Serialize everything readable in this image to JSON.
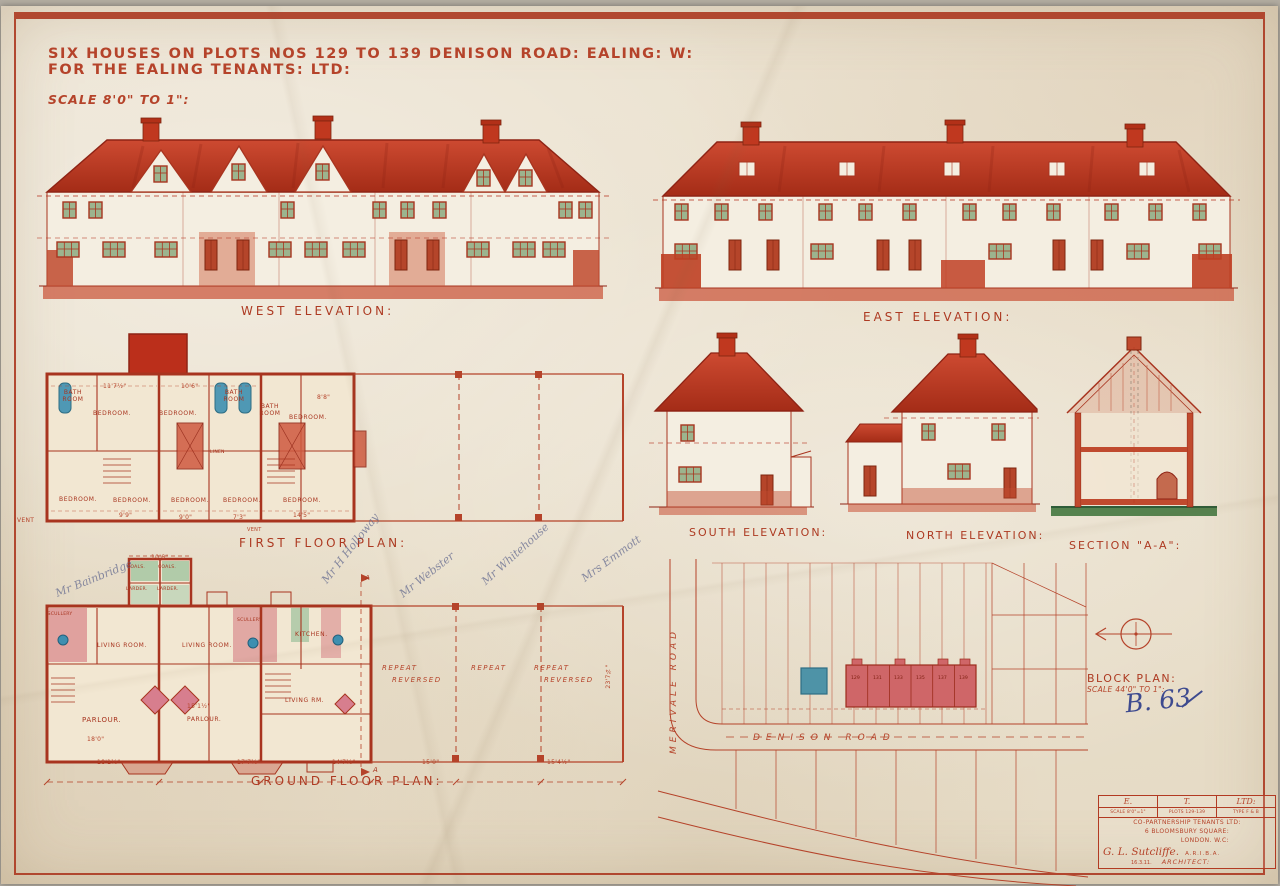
{
  "sheet": {
    "title_line1": "SIX HOUSES ON PLOTS NOS 129 TO 139 DENISON ROAD: EALING: W:",
    "title_line2": "FOR THE EALING TENANTS: LTD:",
    "scale_note": "SCALE 8'0\" TO 1\":",
    "reference": "B. 63"
  },
  "labels": {
    "west": "WEST ELEVATION:",
    "east": "EAST ELEVATION:",
    "first_floor": "FIRST FLOOR PLAN:",
    "ground_floor": "GROUND FLOOR PLAN:",
    "south": "SOUTH ELEVATION:",
    "north": "NORTH ELEVATION:",
    "section": "SECTION \"A-A\":",
    "block_plan": "BLOCK PLAN:",
    "block_scale": "SCALE 44'0\" TO 1\":"
  },
  "first_floor": {
    "rooms": {
      "bath1": "BATH ROOM",
      "bath2": "BATH ROOM",
      "bath3": "BATH ROOM",
      "bed_a": "BEDROOM.",
      "bed_b": "BEDROOM.",
      "bed_c": "BEDROOM.",
      "bed_d": "BEDROOM.",
      "bed_e": "BEDROOM.",
      "bed_f": "BEDROOM.",
      "bed_g": "BEDROOM.",
      "bed_h": "BEDROOM.",
      "linen": "LINEN"
    },
    "dims": {
      "top1": "11'7½\"",
      "top2": "10'6\"",
      "top3": "8'8\"",
      "bot1": "9'9\"",
      "bot2": "9'0\"",
      "bot3": "7'3\"",
      "bot4": "14'5\"",
      "vent": "VENT"
    }
  },
  "ground_floor": {
    "rooms": {
      "coals1": "COALS.",
      "coals2": "COALS.",
      "larder1": "LARDER.",
      "larder2": "LARDER.",
      "scullery1": "SCULLERY",
      "scullery2": "SCULLERY",
      "kitchen": "KITCHEN.",
      "living1": "LIVING ROOM.",
      "living2": "LIVING ROOM.",
      "living3": "LIVING RM.",
      "parlour1": "PARLOUR.",
      "parlour2": "PARLOUR."
    },
    "repeats": {
      "r1l1": "REPEAT",
      "r1l2": "REVERSED",
      "r2": "REPEAT",
      "r3l1": "REPEAT",
      "r3l2": "REVERSED"
    },
    "dims": {
      "top1": "10'6\"",
      "mid1": "15'1½\"",
      "mid2": "18'0\"",
      "bot1": "18'1½\"",
      "bot2": "17'7½\"",
      "bot3": "14'7½\"",
      "bot4": "15'0\"",
      "bot5": "15'4½\"",
      "side": "23'7¾\""
    },
    "marker": "A"
  },
  "block_plan": {
    "merivale": "MERIVALE ROAD",
    "denison": "DENISON ROAD",
    "plots": [
      "129",
      "131",
      "133",
      "135",
      "137",
      "139"
    ]
  },
  "handwriting": {
    "names": [
      "Mr Bainbridge",
      "Mr H Holloway",
      "Mr Webster",
      "Mr Whitehouse",
      "Mrs Emmott"
    ]
  },
  "title_block": {
    "abbr": [
      "E.",
      "T.",
      "LTD:"
    ],
    "meta": [
      "SCALE 8'0\"=1\"",
      "PLOTS 129-139",
      "TYPE F & B"
    ],
    "company1": "CO-PARTNERSHIP TENANTS LTD:",
    "company2": "6 BLOOMSBURY SQUARE:",
    "company3": "LONDON. W.C:",
    "signature": "G. L. Sutcliffe.",
    "credentials": "A.R.I.B.A.",
    "date": "16.3.11.",
    "role": "ARCHITECT:"
  }
}
